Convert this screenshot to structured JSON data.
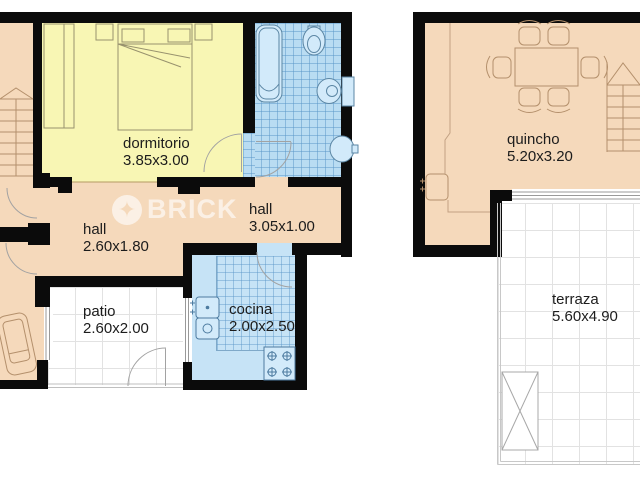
{
  "plan": {
    "watermark": "BRICK",
    "rooms": [
      {
        "name": "dormitorio",
        "dims": "3.85x3.00"
      },
      {
        "name": "hall",
        "dims": "2.60x1.80"
      },
      {
        "name": "hall",
        "dims": "3.05x1.00"
      },
      {
        "name": "patio",
        "dims": "2.60x2.00"
      },
      {
        "name": "cocina",
        "dims": "2.00x2.50"
      },
      {
        "name": "quincho",
        "dims": "5.20x3.20"
      },
      {
        "name": "terraza",
        "dims": "5.60x4.90"
      }
    ],
    "colors": {
      "floor": "#f5d9bb",
      "bedroom": "#f8f6b4",
      "bath_tile": "#b9dcf2",
      "kitchen_tile": "#c6e3f6",
      "wall": "#0b0b0b",
      "grid": "#e2e2e2",
      "wood_outline": "#b4906c",
      "fixture_fill": "#d2eafa",
      "fixture_stroke": "#4d7ba0"
    }
  }
}
